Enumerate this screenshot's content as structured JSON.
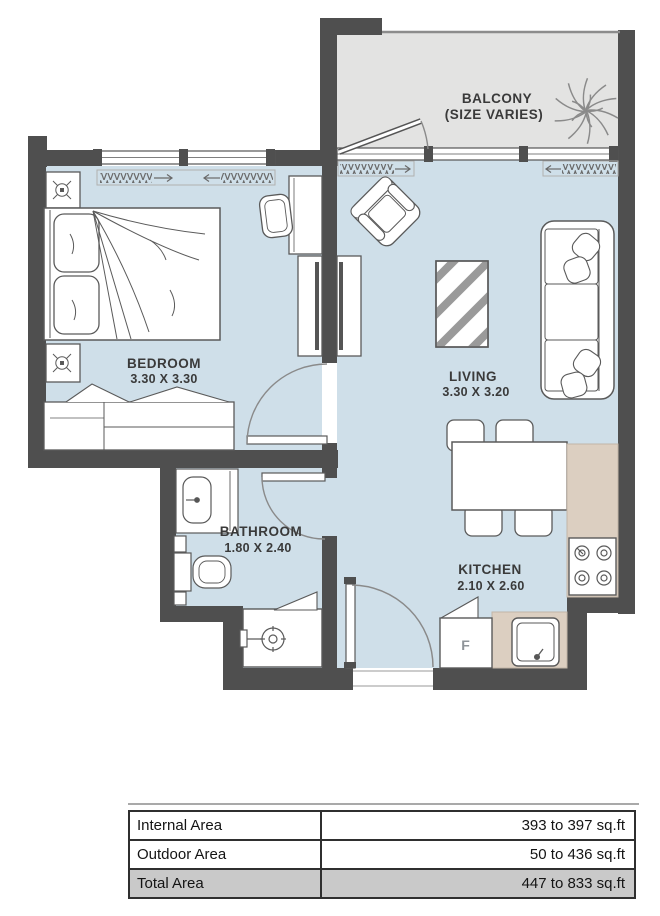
{
  "plan": {
    "balcony": {
      "label": "BALCONY",
      "note": "(SIZE VARIES)"
    },
    "bedroom": {
      "label": "BEDROOM",
      "dims": "3.30 X 3.30"
    },
    "living": {
      "label": "LIVING",
      "dims": "3.30 X 3.20"
    },
    "bathroom": {
      "label": "BATHROOM",
      "dims": "1.80 X 2.40"
    },
    "kitchen": {
      "label": "KITCHEN",
      "dims": "2.10 X 2.60"
    },
    "fridge_label": "F"
  },
  "area_table": {
    "rows": [
      {
        "label": "Internal Area",
        "value": "393 to 397 sq.ft"
      },
      {
        "label": "Outdoor Area",
        "value": "50 to 436 sq.ft"
      },
      {
        "label": "Total Area",
        "value": "447 to 833 sq.ft"
      }
    ]
  },
  "colors": {
    "wall": "#4f4f4f",
    "room_floor": "#cfdfe9",
    "balcony_floor": "#e3e3e2",
    "counter": "#dccfc1",
    "furniture_outline": "#5a5a5a",
    "door_arc": "#8a8a8a",
    "label_text": "#3a3a3a",
    "table_total_bg": "#c9c9c9"
  }
}
